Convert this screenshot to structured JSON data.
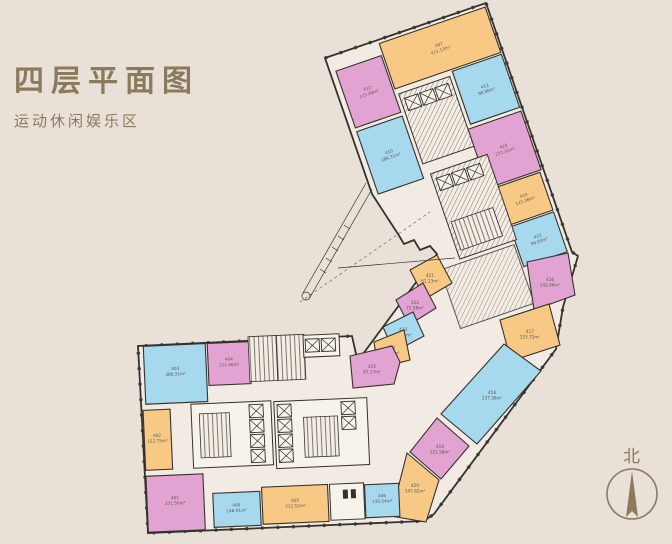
{
  "page": {
    "title": "四层平面图",
    "subtitle": "运动休闲娱乐区"
  },
  "compass": {
    "label": "北"
  },
  "palette": {
    "background": "#e9e1d8",
    "interior": "#f2ebe3",
    "wall": "#35322c",
    "pink": "#e2a3d3",
    "blue": "#a6d8ee",
    "orange": "#f7c985",
    "core": "#f7f2ea",
    "accent": "#8c7a5d",
    "label": "#5c5650"
  },
  "rooms": {
    "r407": {
      "number": "407",
      "area": "411.13m²",
      "color": "orange"
    },
    "r412": {
      "number": "412",
      "area": "115.49m²",
      "color": "pink"
    },
    "r410": {
      "number": "410",
      "area": "186.31m²",
      "color": "blue"
    },
    "r411": {
      "number": "411",
      "area": "98.06m²",
      "color": "blue"
    },
    "r413": {
      "number": "413",
      "area": "272.31m²",
      "color": "pink"
    },
    "r414": {
      "number": "414",
      "area": "111.08m²",
      "color": "orange"
    },
    "r415": {
      "number": "415",
      "area": "96.03m²",
      "color": "blue"
    },
    "r416": {
      "number": "416",
      "area": "142.46m²",
      "color": "pink"
    },
    "r417": {
      "number": "417",
      "area": "115.72m²",
      "color": "orange"
    },
    "r418": {
      "number": "418",
      "area": "137.36m²",
      "color": "blue"
    },
    "r419": {
      "number": "419",
      "area": "121.58m²",
      "color": "pink"
    },
    "r420": {
      "number": "420",
      "area": "147.62m²",
      "color": "orange"
    },
    "r421": {
      "number": "421",
      "area": "61.13m²",
      "color": "orange"
    },
    "r422": {
      "number": "422",
      "area": "72.58m²",
      "color": "pink"
    },
    "r423": {
      "number": "423",
      "area": "66.21m²",
      "color": "blue"
    },
    "r424": {
      "number": "424",
      "area": "71.30m²",
      "color": "orange"
    },
    "r425": {
      "number": "425",
      "area": "87.17m²",
      "color": "pink"
    },
    "r403": {
      "number": "403",
      "area": "388.31m²",
      "color": "blue"
    },
    "r404": {
      "number": "404",
      "area": "111.46m²",
      "color": "pink"
    },
    "r402": {
      "number": "402",
      "area": "122.75m²",
      "color": "orange"
    },
    "r401": {
      "number": "401",
      "area": "271.56m²",
      "color": "pink"
    },
    "r400": {
      "number": "400",
      "area": "146.91m²",
      "color": "blue"
    },
    "r405": {
      "number": "405",
      "area": "212.52m²",
      "color": "orange"
    },
    "r406": {
      "number": "406",
      "area": "135.04m²",
      "color": "blue"
    }
  }
}
